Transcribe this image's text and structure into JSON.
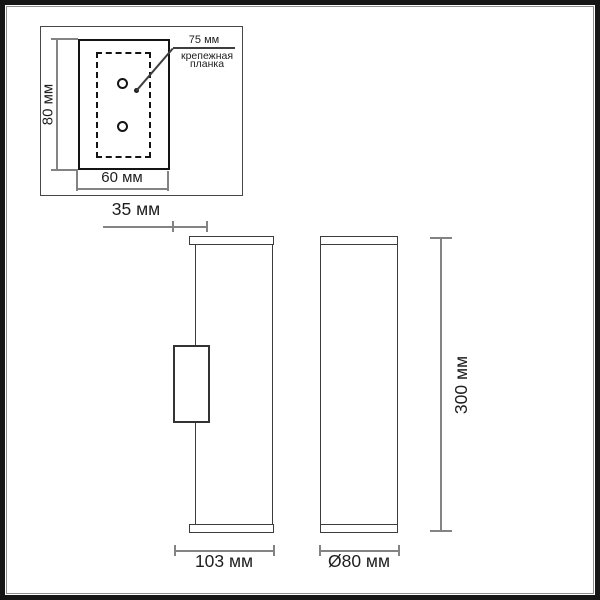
{
  "diagram": {
    "plate_view": {
      "height_label": "80 мм",
      "width_label": "60 мм",
      "callout_value": "75 мм",
      "callout_caption": [
        "крепежная",
        "планка"
      ]
    },
    "side_view": {
      "bracket_depth_label": "35 мм",
      "total_depth_label": "103 мм"
    },
    "front_view": {
      "height_label": "300 мм",
      "diameter_label": "Ø80 мм"
    }
  },
  "colors": {
    "background": "#ffffff",
    "frame": "#161616",
    "plate_line": "#141414",
    "body_line": "#3c3c3c",
    "dimension_line": "#838383",
    "text": "#1e1e1e"
  }
}
